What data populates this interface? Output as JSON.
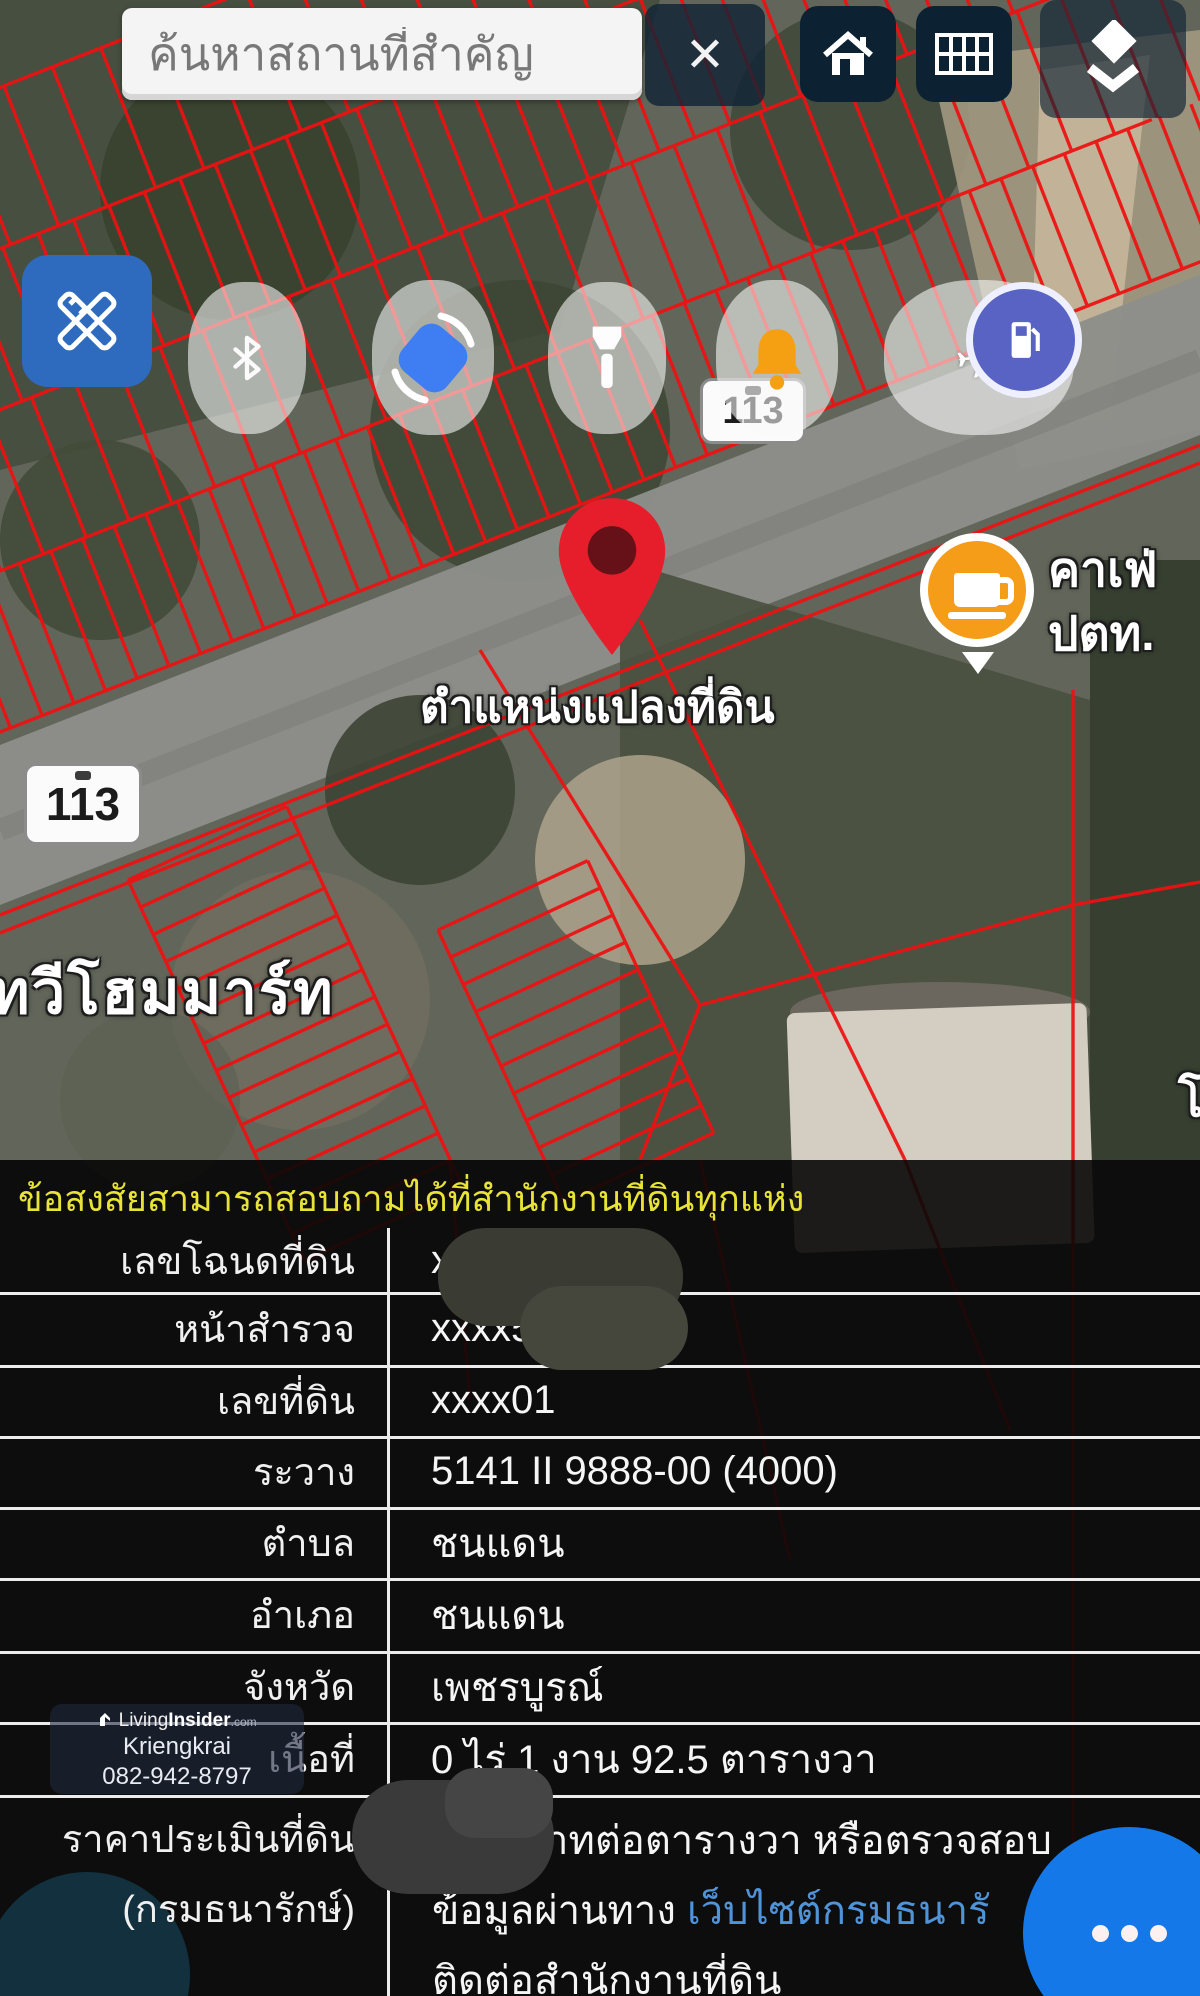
{
  "topbar": {
    "search_placeholder": "ค้นหาสถานที่สำคัญ",
    "close": "✕"
  },
  "map": {
    "road_badge_1": "113",
    "road_badge_2": "113",
    "pin_label": "ตำแหน่งแปลงที่ดิน",
    "store_label": "ทวีโฮมมาร์ท",
    "cafe_line1": "คาเฟ่",
    "cafe_line2": "ปตท.",
    "partial_label": "โ"
  },
  "panel": {
    "notice": "ข้อสงสัยสามารถสอบถามได้ที่สำนักงานที่ดินทุกแห่ง",
    "rows": [
      {
        "label": "เลขโฉนดที่ดิน",
        "value": "x"
      },
      {
        "label": "หน้าสำรวจ",
        "value": "xxxx5"
      },
      {
        "label": "เลขที่ดิน",
        "value": "xxxx01"
      },
      {
        "label": "ระวาง",
        "value": "5141 II 9888-00 (4000)"
      },
      {
        "label": "ตำบล",
        "value": "ชนแดน"
      },
      {
        "label": "อำเภอ",
        "value": "ชนแดน"
      },
      {
        "label": "จังหวัด",
        "value": "เพชรบูรณ์"
      },
      {
        "label": "เนื้อที่",
        "value": "0 ไร่ 1 งาน 92.5 ตารางวา"
      }
    ],
    "price": {
      "label_line1": "ราคาประเมินที่ดิน",
      "label_line2": "(กรมธนารักษ์)",
      "value_line1": "าทต่อตารางวา หรือตรวจสอบ",
      "value_line2_prefix": "ข้อมูลผ่านทาง ",
      "value_line2_link": "เว็บไซต์กรมธนารั",
      "value_line3": "ติดต่อสำนักงานที่ดิน"
    }
  },
  "watermark": {
    "brand_light": "Living",
    "brand_bold": "Insider",
    "brand_tld": ".com",
    "name": "Kriengkrai",
    "phone": "082-942-8797"
  },
  "fab_dots": "•••",
  "colors": {
    "accent_blue": "#1478e8",
    "link_blue": "#4f93d8",
    "notice_yellow": "#e8e337",
    "parcel_red": "#ee1111",
    "marker_orange": "#f59d18",
    "pin_red": "#e61e2b",
    "toolbar_navy": "#0c2232"
  }
}
